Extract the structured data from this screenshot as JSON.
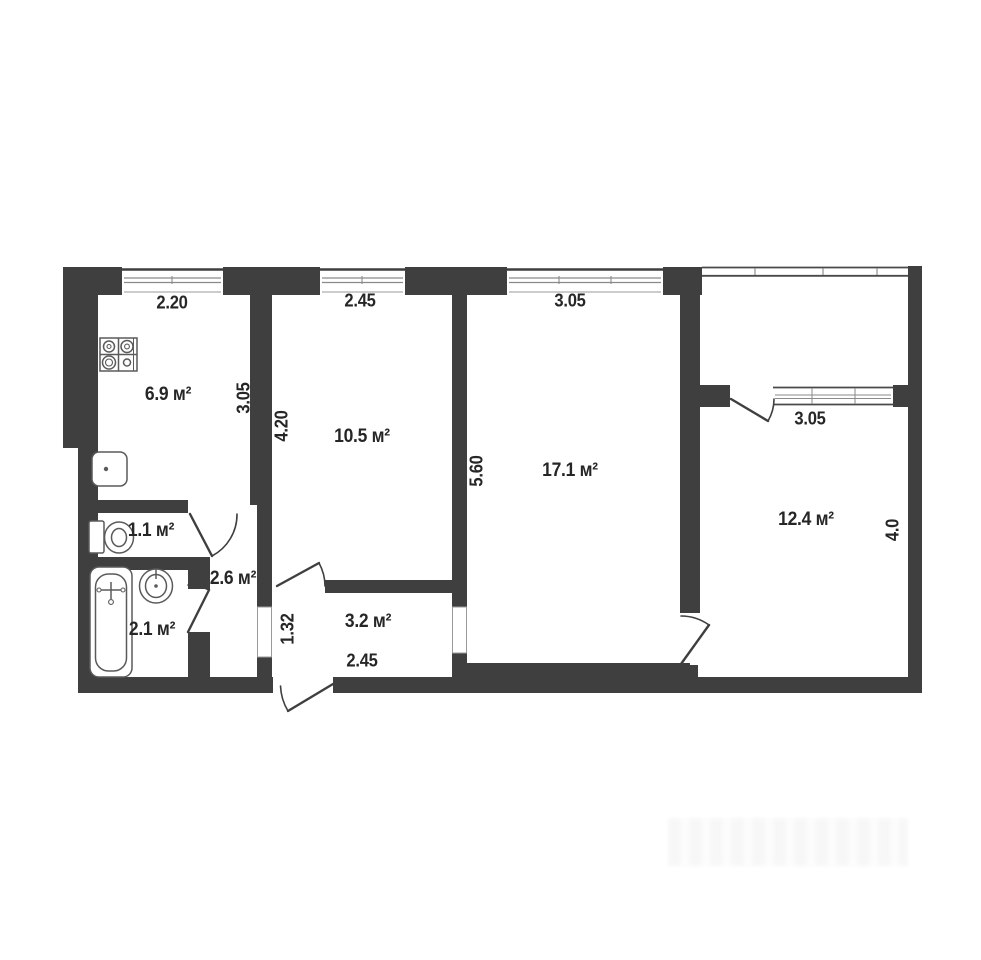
{
  "meta": {
    "type": "apartment floor plan"
  },
  "colors": {
    "wall": "#3f3f3f",
    "background": "#ffffff",
    "fixture_line": "#5a5a5a",
    "text": "#262626"
  },
  "rooms": {
    "kitchen": {
      "label": "6.9 м²"
    },
    "room_10_5": {
      "label": "10.5 м²"
    },
    "room_17_1": {
      "label": "17.1 м²"
    },
    "room_12_4": {
      "label": "12.4 м²"
    },
    "wc": {
      "label": "1.1 м²"
    },
    "bathroom": {
      "label": "2.1 м²"
    },
    "hallway": {
      "label": "2.6 м²"
    },
    "corridor": {
      "label": "3.2 м²"
    }
  },
  "dimensions": {
    "kitchen_width": "2.20",
    "kitchen_depth": "3.05",
    "room_10_5_width": "2.45",
    "room_10_5_depth": "4.20",
    "room_17_1_width": "3.05",
    "room_17_1_depth": "5.60",
    "room_12_4_window": "3.05",
    "room_12_4_depth": "4.0",
    "corridor_width": "2.45",
    "corridor_depth": "1.32"
  },
  "fixtures": {
    "stove": "stove-icon",
    "kitchen_sink": "sink-icon",
    "toilet": "toilet-icon",
    "bathtub": "bathtub-icon",
    "wash_basin": "wash-basin-icon"
  }
}
